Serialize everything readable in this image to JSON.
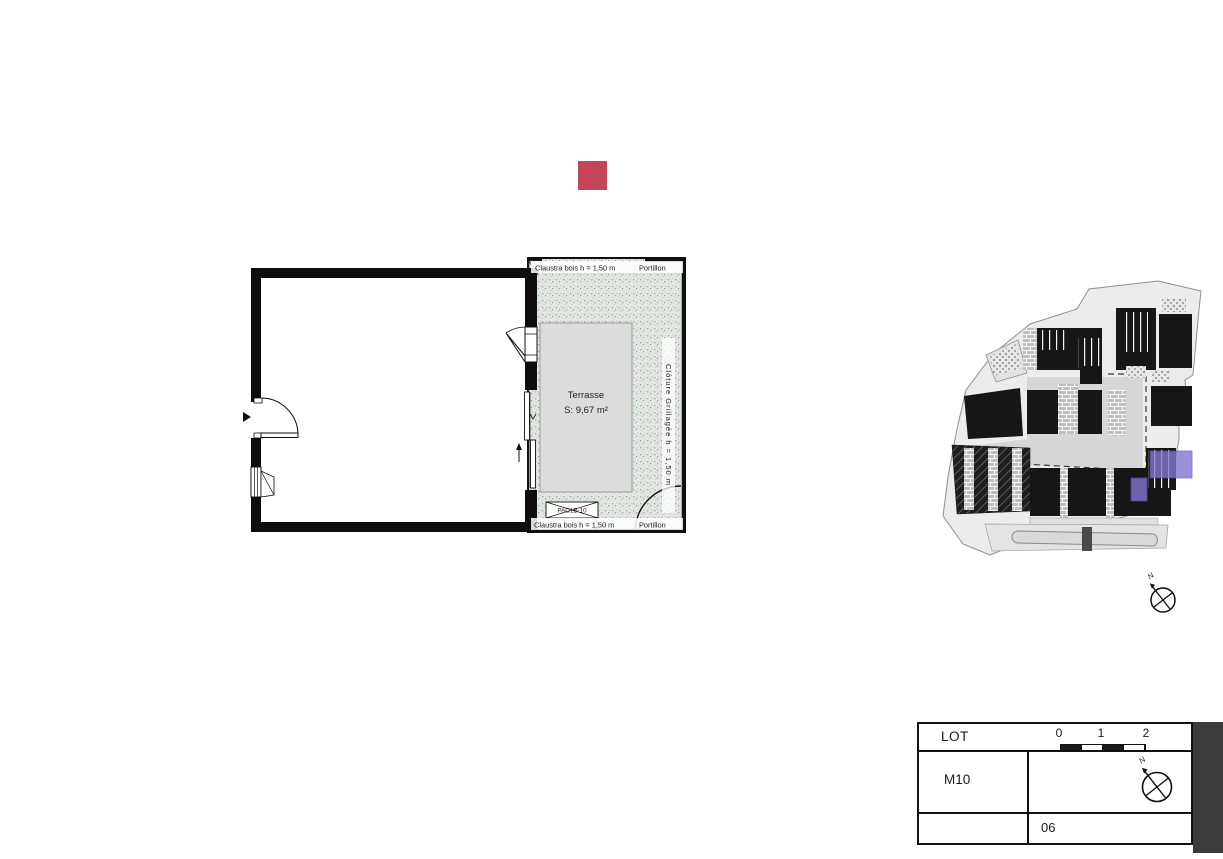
{
  "legend_marker": {
    "color": "#c3455a"
  },
  "floor_plan": {
    "terrace": {
      "label": "Terrasse",
      "area": "S: 9,67 m²",
      "fence_top_label": "Claustra bois h = 1,50 m",
      "gate_top_label": "Portillon",
      "fence_right_label": "Clôture Grillagée h = 1,50 m",
      "fence_bottom_label": "Claustra bois h = 1,50 m",
      "gate_bottom_label": "Portillon",
      "equipment_tag": "PAC1B-10"
    }
  },
  "site_plan": {
    "north_label": "N",
    "highlight_color": "#8277cf"
  },
  "title_block": {
    "lot_label": "LOT",
    "lot_value": "M10",
    "sheet_number": "06",
    "north_label": "N",
    "scale_ticks": [
      "0",
      "1",
      "2"
    ]
  }
}
